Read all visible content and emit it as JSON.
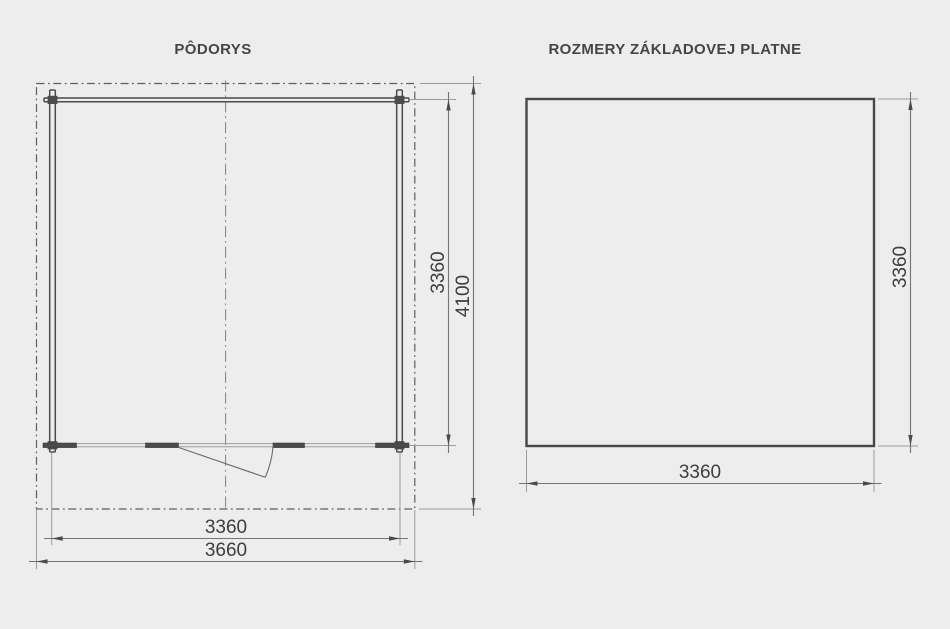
{
  "colors": {
    "background": "#ededed",
    "wall_line": "#4b4b4b",
    "roof_dashed_line": "#5f5f5f",
    "dimension_line": "#757575",
    "extension_line": "#9b9b9b",
    "text": "#3e3e3e"
  },
  "floor_plan": {
    "title": "PÔDORYS",
    "dim_inner_width": "3360",
    "dim_outer_width": "3660",
    "dim_inner_height": "3360",
    "dim_outer_height": "4100"
  },
  "base_plate": {
    "title": "ROZMERY ZÁKLADOVEJ PLATNE",
    "dim_width": "3360",
    "dim_height": "3360"
  }
}
